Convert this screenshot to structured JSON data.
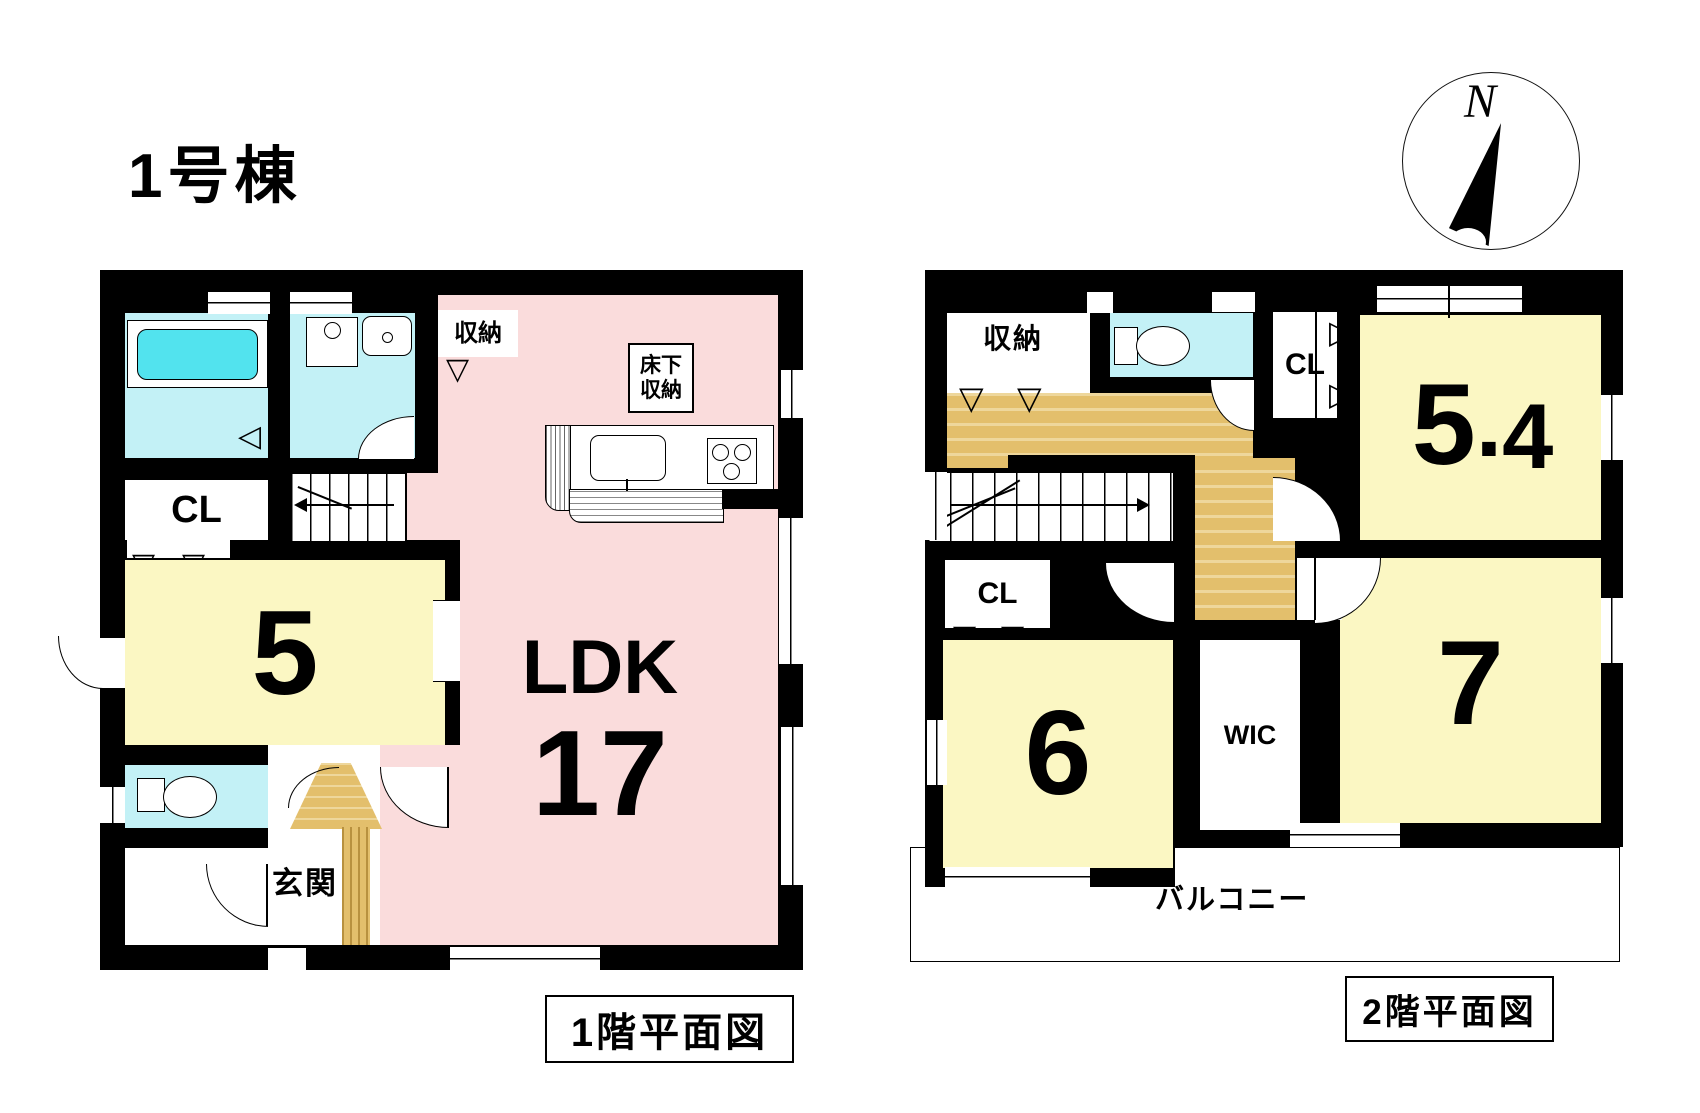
{
  "title": "1号棟",
  "compass": {
    "label": "N"
  },
  "icons": {
    "wedge_down": "▽",
    "wedge_left": "◁",
    "wedge_right": "▷"
  },
  "colors": {
    "wall": "#000000",
    "wet_room": "#c3f1f6",
    "bathtub": "#52e3ee",
    "room_yellow": "#fbf7c3",
    "ldk_pink": "#fadcdc",
    "wood": "#e3bf6c"
  },
  "floor1": {
    "caption": "1階平面図",
    "rooms": {
      "storage": {
        "label": "収納"
      },
      "underfloor_storage": {
        "line1": "床下",
        "line2": "収納"
      },
      "closet": {
        "label": "CL"
      },
      "bedroom5": {
        "label": "5"
      },
      "ldk": {
        "name": "LDK",
        "size": "17"
      },
      "entrance": {
        "label": "玄関"
      }
    }
  },
  "floor2": {
    "caption": "2階平面図",
    "rooms": {
      "storage": {
        "label": "収納"
      },
      "closet_upper": {
        "label": "CL"
      },
      "bedroom54": {
        "whole": "5",
        "dot": ".",
        "decimal": "4"
      },
      "closet_mid": {
        "label": "CL"
      },
      "bedroom6": {
        "label": "6"
      },
      "wic": {
        "label": "WIC"
      },
      "bedroom7": {
        "label": "7"
      },
      "balcony": {
        "label": "バルコニー"
      }
    }
  }
}
